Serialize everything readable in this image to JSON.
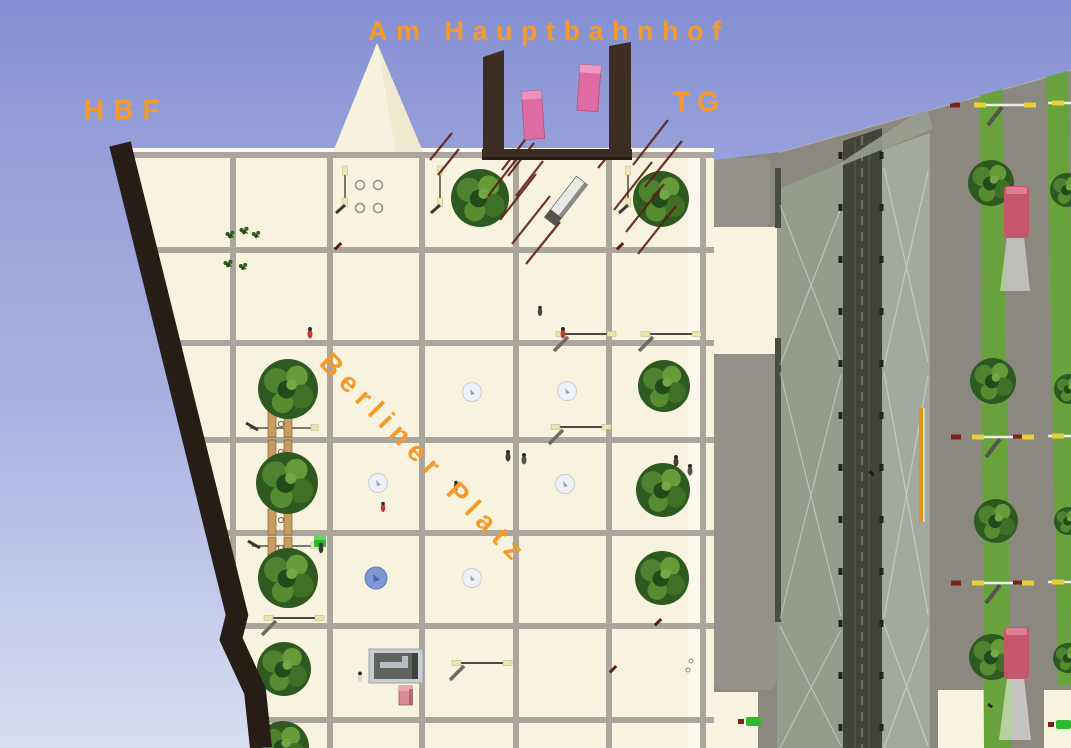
{
  "labels": {
    "street": "Am Hauptbahnhof",
    "station": "HBF",
    "garage": "TG",
    "plaza": "Berliner Platz"
  },
  "palette": {
    "label_orange": "#F49A2B",
    "sky_top": "#8590D3",
    "sky_mid": "#AAB2E0",
    "sky_bottom": "#D8DDF2",
    "plaza_cream": "#F8F3DE",
    "grid_gray": "#A6A29A",
    "edge_band": "#261E16",
    "structure_brown": "#3B2D21",
    "elevator_pink": "#DE6BA4",
    "tree_green": "#2E5A21",
    "road_gray": "#8B8880",
    "sidewalk_gray": "#94928B",
    "canopy_glass": "#969D8F",
    "track_slot": "#42443C",
    "grass_green": "#68A23C",
    "bus_red": "#C5576D",
    "bench_wood": "#C99C5F",
    "hatch_red": "#5E1E14",
    "platform_orange": "#E8930F",
    "fountain_blue": "#7E98D4"
  }
}
